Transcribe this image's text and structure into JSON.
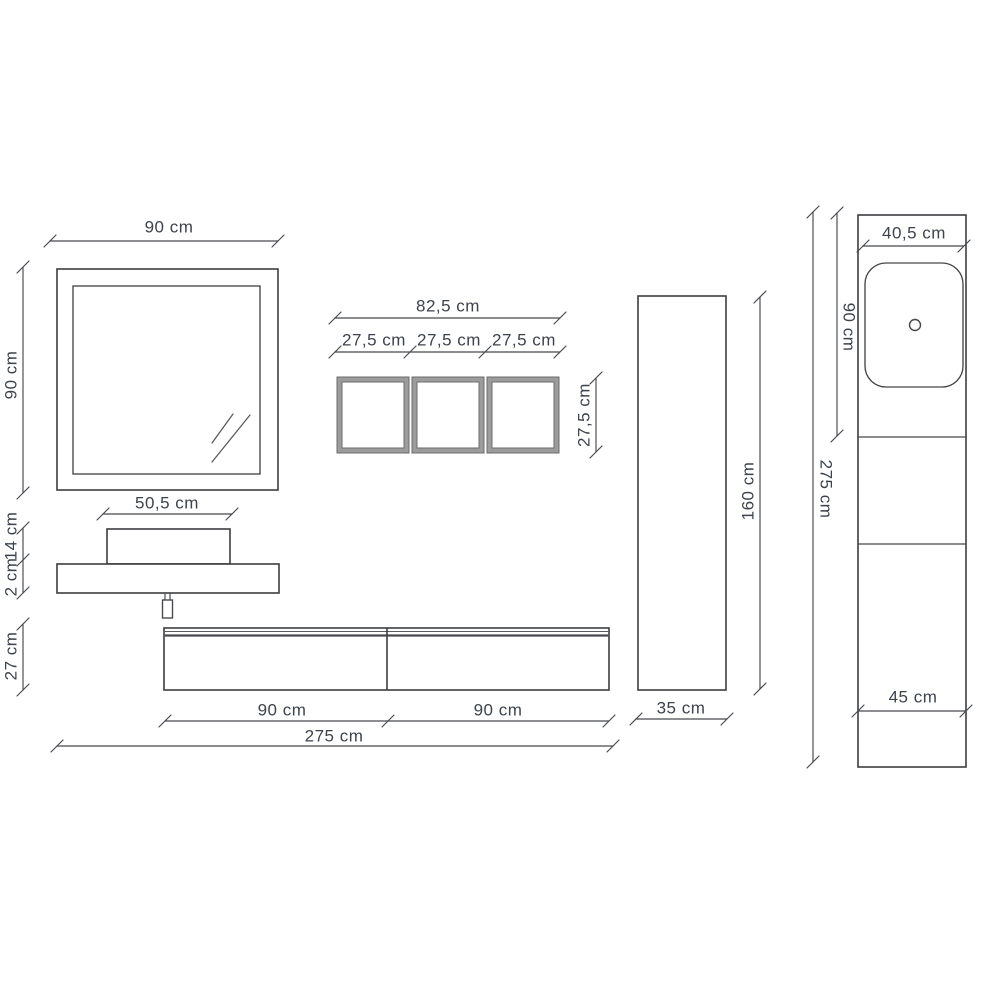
{
  "drawing": {
    "title": "Bathroom furniture dimensional drawing",
    "units": "cm"
  },
  "mirror": {
    "width": "90 cm",
    "height": "90 cm"
  },
  "open_shelves": {
    "total_width": "82,5 cm",
    "module_widths": [
      "27,5 cm",
      "27,5 cm",
      "27,5 cm"
    ],
    "height": "27,5 cm"
  },
  "washbasin": {
    "width": "50,5 cm",
    "basin_height": "14 cm",
    "countertop_thickness": "2 cm"
  },
  "base_cabinet": {
    "height": "27 cm",
    "left_module_width": "90 cm",
    "right_module_width": "90 cm",
    "total_width": "275 cm"
  },
  "tall_cabinet": {
    "height": "160 cm",
    "width": "35 cm"
  },
  "side_view": {
    "top_depth": "40,5 cm",
    "basin_section_height": "90 cm",
    "total_height": "275 cm",
    "base_depth": "45 cm"
  },
  "colors": {
    "line": "#46494e",
    "outline": "#3c3d40",
    "text": "#3d434c",
    "shelf_frame_gray": "#9c9c9c",
    "background": "#ffffff"
  }
}
